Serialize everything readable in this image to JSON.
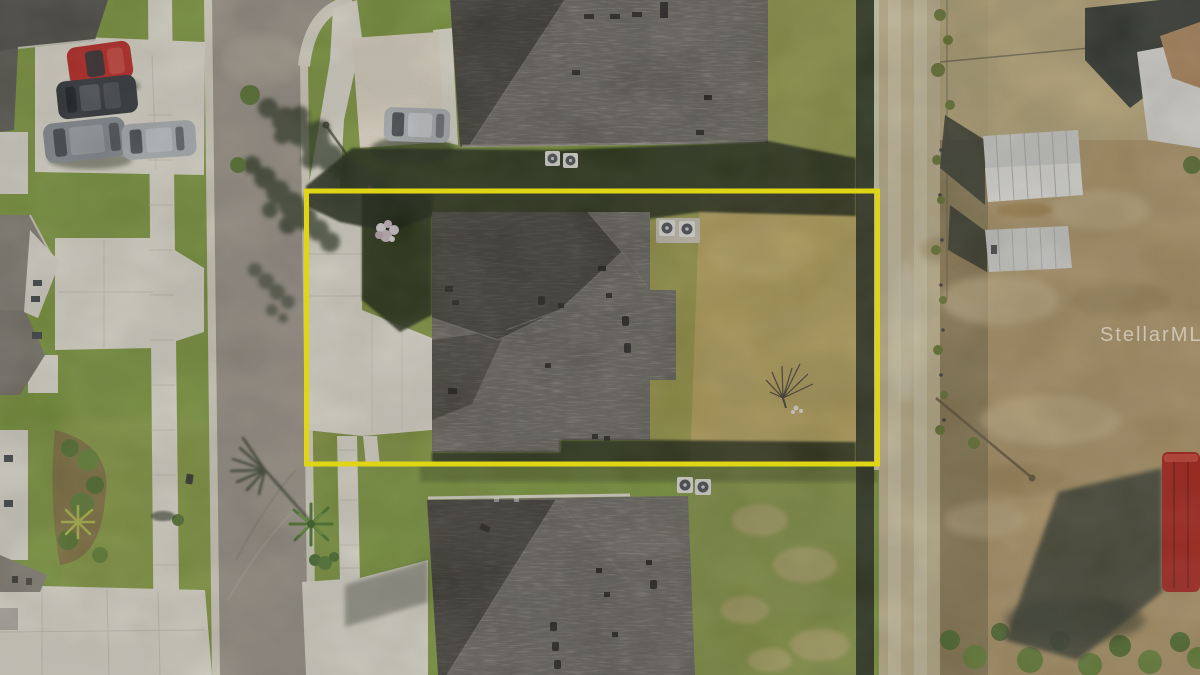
{
  "watermark": {
    "text": "StellarMLS"
  },
  "annotation": {
    "shape": "rectangle",
    "color": "#f7ec18"
  },
  "palette": {
    "lawn": "#84a041",
    "lawn_bright": "#97a94b",
    "lawn_dry": "#bfaa61",
    "lawn_transition": "#a6a050",
    "street": "#a39b8f",
    "concrete": "#ece8da",
    "paver": "#d9c6a0",
    "roof_light": "#a29e92",
    "roof_mid": "#8b877c",
    "roof_dark": "#5f5c52",
    "shadow_dark": "#222c17",
    "dirt_field": "#b89e6e",
    "dirt_road": "#c9bb94",
    "scrub": "#95835a",
    "fence_dark": "#2a3020",
    "shed_white": "#dcdcd8",
    "building_shadow": "#3b3f38",
    "building_wall": "#e8e6df",
    "building_roof": "#b98f62",
    "car_red": "#c52822",
    "car_black": "#35383d",
    "car_gray": "#8f959b",
    "car_silver": "#b9bdc0",
    "trailer_red": "#b3281e",
    "boundary_yellow": "#f7ec18",
    "watermark_white": "rgba(255,255,255,0.5)"
  }
}
